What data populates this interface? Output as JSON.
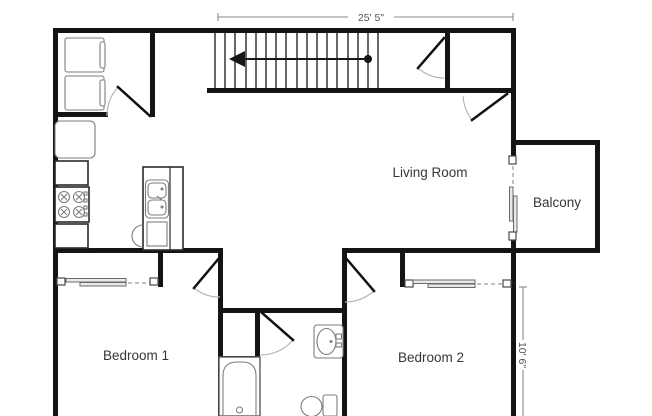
{
  "plan": {
    "labels": {
      "living_room": "Living Room",
      "balcony": "Balcony",
      "bedroom_1": "Bedroom 1",
      "bedroom_2": "Bedroom 2"
    },
    "dimensions": {
      "top_width": "25' 5\"",
      "right_height": "10' 6\""
    },
    "colors": {
      "wall": "#141414",
      "fixture_outline": "#7d7d7d",
      "dimension_line": "#8a8a8a",
      "label_text": "#363636"
    },
    "fixtures": [
      "stairs-icon",
      "washer-icon",
      "dryer-icon",
      "refrigerator-icon",
      "stove-icon",
      "kitchen-sink-icon",
      "dishwasher-icon",
      "bathtub-icon",
      "toilet-icon",
      "bathroom-sink-icon",
      "door-swing-icon",
      "sliding-door-icon"
    ]
  }
}
